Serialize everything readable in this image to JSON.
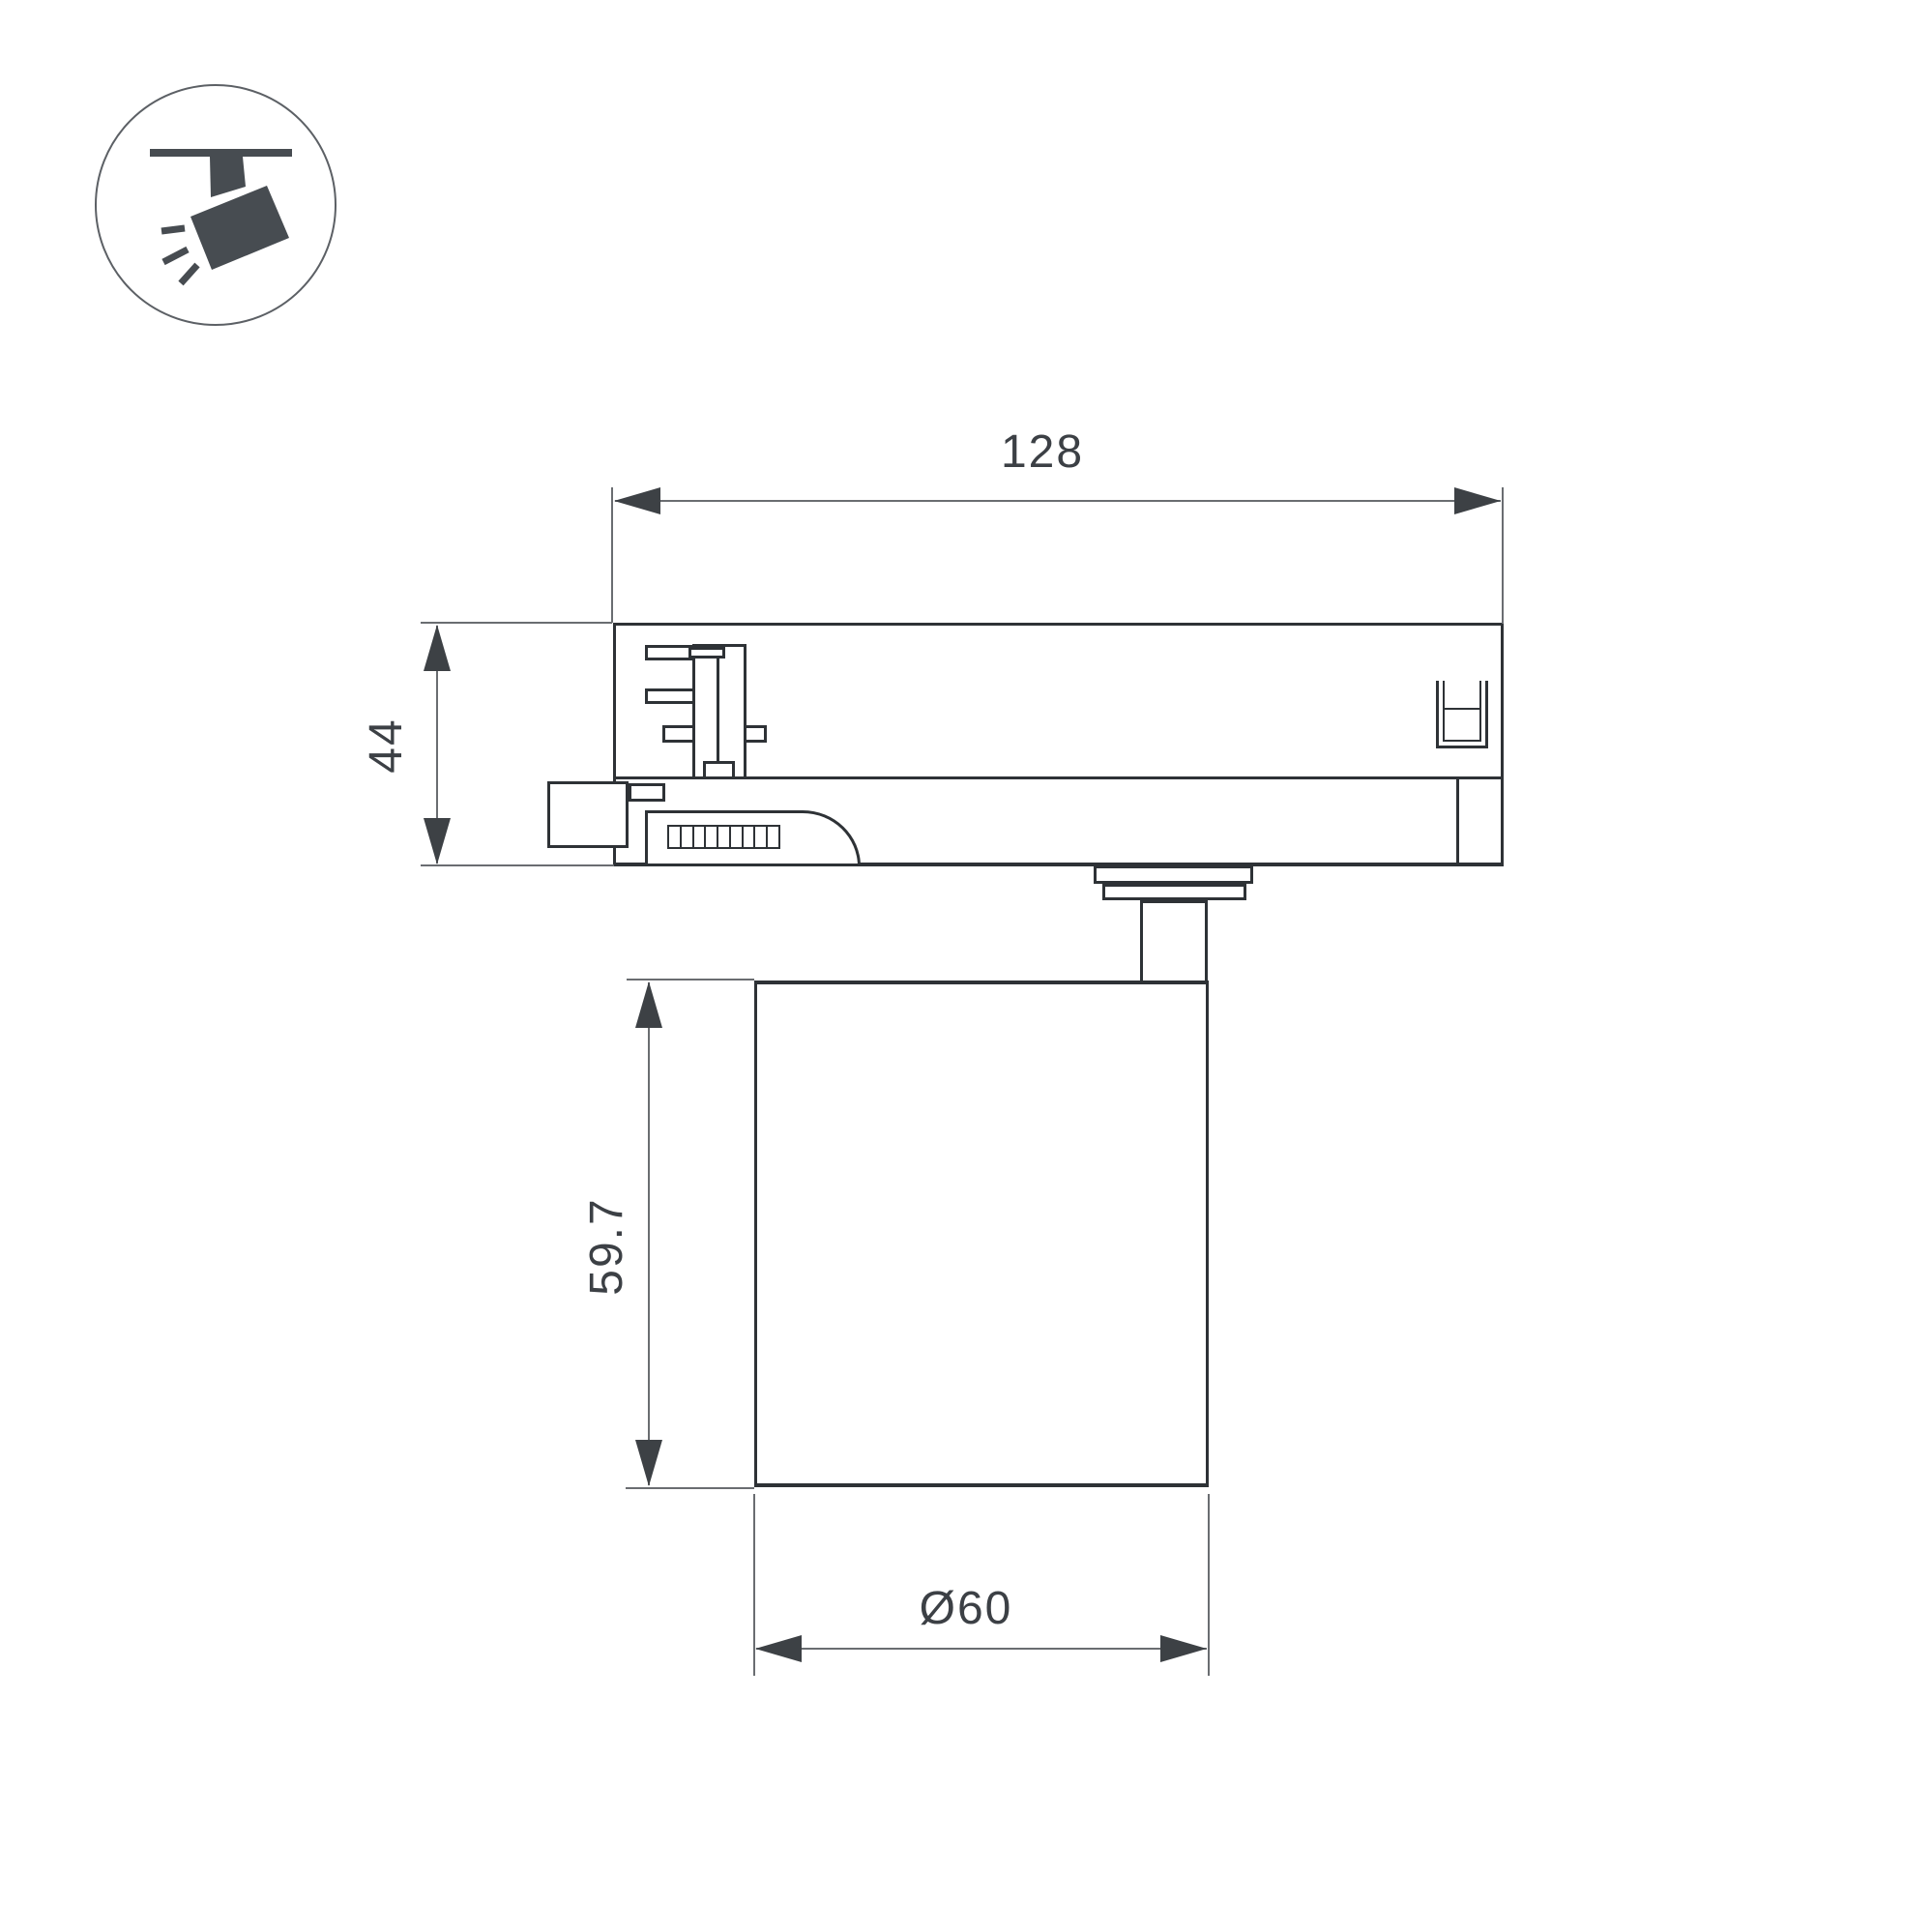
{
  "drawing": {
    "type": "technical-dimension-drawing",
    "subject": "track-mounted spotlight side view",
    "colors": {
      "background": "#ffffff",
      "outline": "#2e3236",
      "dimension_line": "#6a6d71",
      "arrow": "#3d4145",
      "text": "#3c4045",
      "icon": "#474c51"
    },
    "icon": {
      "name": "track-spotlight-icon",
      "description": "circle badge with ceiling track and tilted spotlight emitting rays"
    },
    "dims": {
      "width": "128",
      "height": "44",
      "body_height": "59.7",
      "diameter": "Ø60"
    }
  }
}
